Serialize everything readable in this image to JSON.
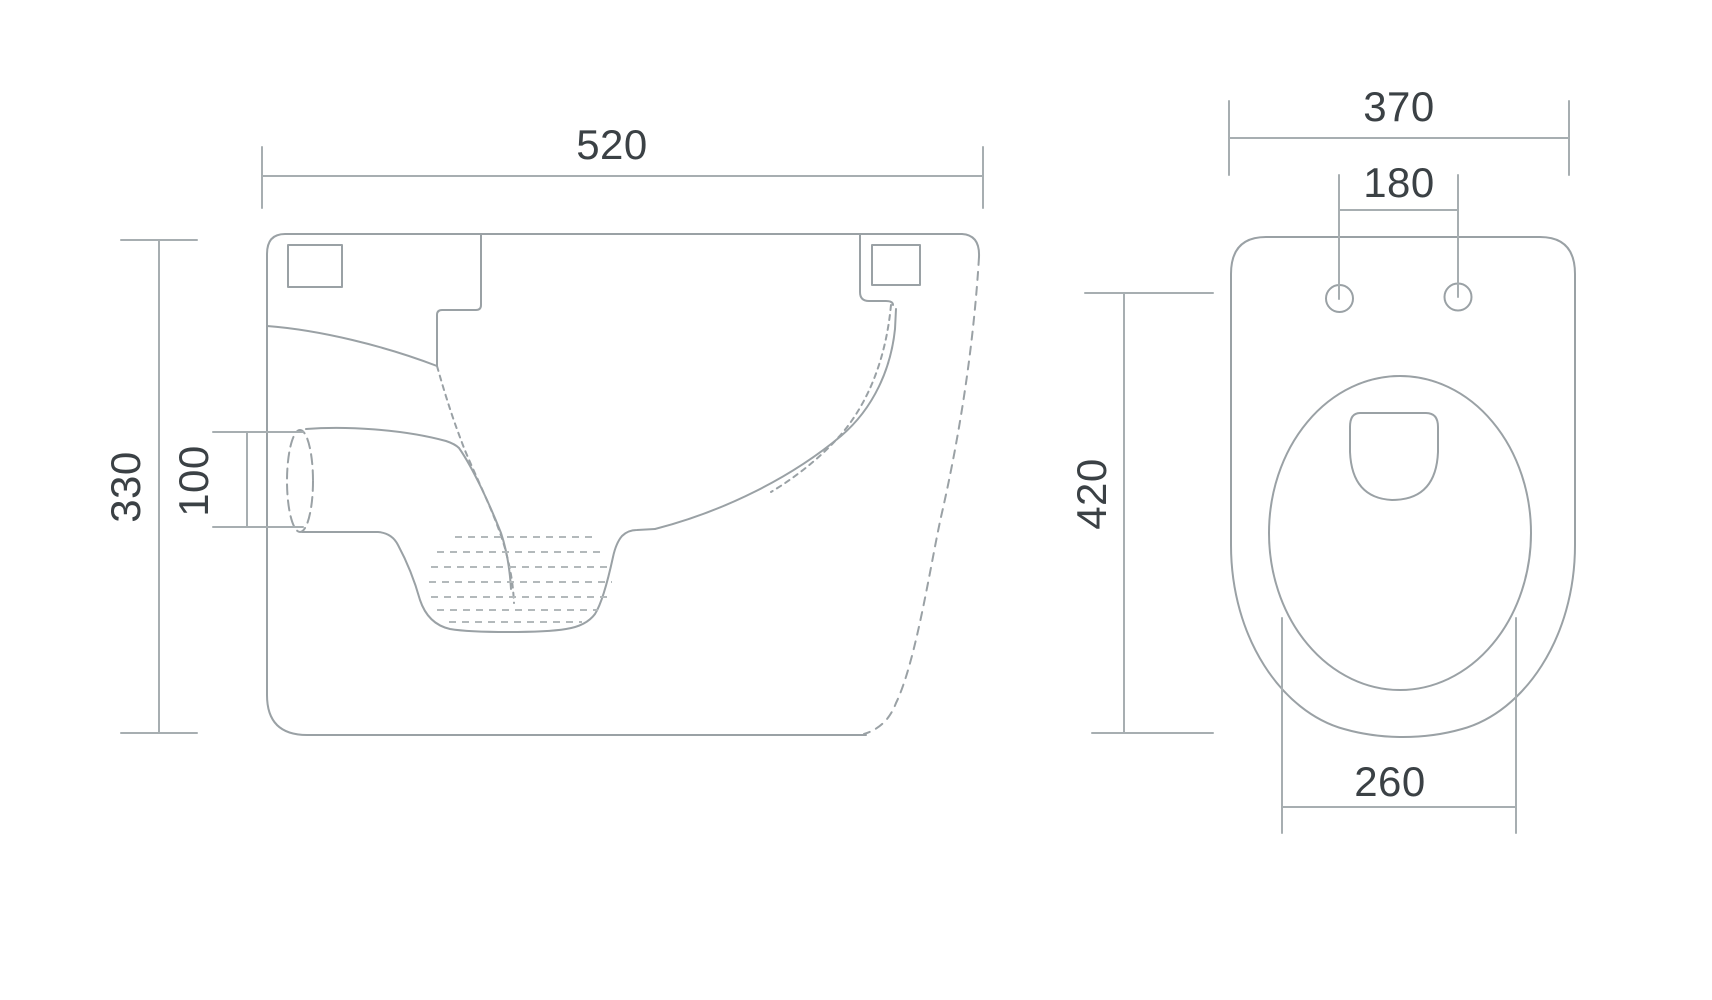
{
  "drawing": {
    "colors": {
      "outline": "#9aa1a5",
      "dimension": "#a7aeb1",
      "water": "#b3b9bb",
      "text": "#3b4145",
      "background": "#ffffff"
    },
    "side_view": {
      "dimensions": {
        "overall_width": "520",
        "overall_height": "330",
        "outlet_diameter": "100"
      }
    },
    "top_view": {
      "dimensions": {
        "overall_width": "370",
        "fixing_hole_spacing": "180",
        "overall_depth": "420",
        "bowl_opening_width": "260"
      }
    }
  }
}
